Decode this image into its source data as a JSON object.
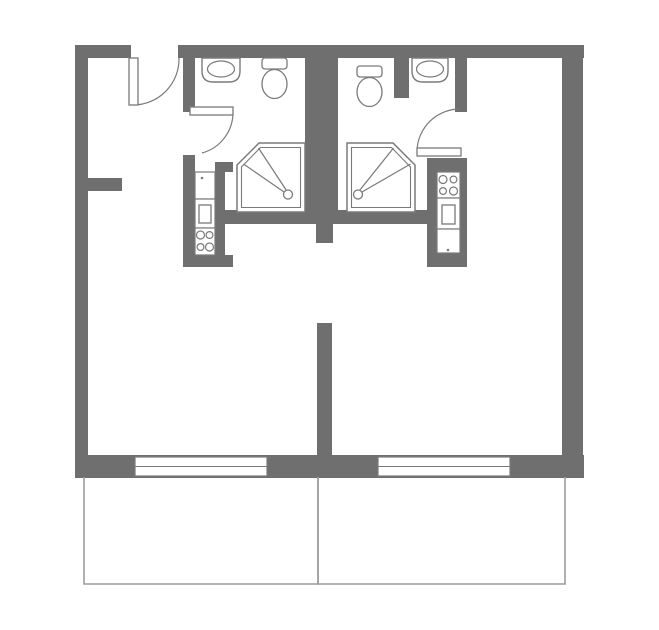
{
  "title": "two-studio-apartment-floor-plan",
  "canvas": {
    "width": 659,
    "height": 630,
    "background": "#ffffff"
  },
  "colors": {
    "wall": "#6f6f6f",
    "fixture_stroke": "#7a7a7a",
    "thin_line": "#9c9c9c",
    "fill": "#ffffff"
  },
  "walls": [
    {
      "name": "outer-wall-left",
      "rect": [
        75,
        45,
        13,
        433
      ]
    },
    {
      "name": "outer-wall-top-left-stub",
      "rect": [
        75,
        45,
        56,
        13
      ]
    },
    {
      "name": "outer-wall-top",
      "rect": [
        178,
        45,
        406,
        13
      ]
    },
    {
      "name": "outer-wall-right",
      "rect": [
        562,
        45,
        21,
        433
      ]
    },
    {
      "name": "outer-wall-bottom",
      "rect": [
        75,
        455,
        509,
        23
      ]
    },
    {
      "name": "hall-closet-stub",
      "rect": [
        88,
        178,
        34,
        13
      ]
    },
    {
      "name": "bath-left-wall-upper",
      "rect": [
        183,
        58,
        12,
        54
      ]
    },
    {
      "name": "bath-left-wall-lower",
      "rect": [
        183,
        155,
        12,
        112
      ]
    },
    {
      "name": "kitchen-left-wall-right",
      "rect": [
        215,
        162,
        10,
        95
      ]
    },
    {
      "name": "kitchen-left-wall-top",
      "rect": [
        215,
        162,
        18,
        10
      ]
    },
    {
      "name": "kitchen-left-wall-bottom",
      "rect": [
        183,
        255,
        50,
        12
      ]
    },
    {
      "name": "center-shaft-wall",
      "rect": [
        305,
        58,
        33,
        166
      ]
    },
    {
      "name": "shower-south-wall",
      "rect": [
        225,
        210,
        212,
        14
      ]
    },
    {
      "name": "room-divider-stub",
      "rect": [
        316,
        224,
        17,
        19
      ]
    },
    {
      "name": "room-divider-wall",
      "rect": [
        317,
        323,
        15,
        132
      ]
    },
    {
      "name": "bath-right-inner-stub",
      "rect": [
        394,
        58,
        15,
        40
      ]
    },
    {
      "name": "bath-right-wall-upper",
      "rect": [
        455,
        58,
        12,
        54
      ]
    },
    {
      "name": "kitchen-right-wall-top",
      "rect": [
        427,
        158,
        40,
        14
      ]
    },
    {
      "name": "kitchen-right-wall-left",
      "rect": [
        427,
        158,
        10,
        107
      ]
    },
    {
      "name": "kitchen-right-wall-back",
      "rect": [
        460,
        172,
        7,
        81
      ]
    },
    {
      "name": "kitchen-right-wall-bottom",
      "rect": [
        427,
        253,
        40,
        14
      ]
    }
  ],
  "doors": [
    {
      "name": "entry-door",
      "leaf": [
        129,
        58,
        9,
        47
      ],
      "arc": "M 133,105 A 46,46 0 0 0 179,58"
    },
    {
      "name": "bathroom-left-door",
      "leaf": [
        190,
        107,
        43,
        8
      ],
      "arc": "M 233,113 A 42,42 0 0 1 202,153"
    },
    {
      "name": "bathroom-right-door",
      "leaf": [
        417,
        148,
        44,
        8
      ],
      "arc": "M 417,151 A 43,43 0 0 1 460,109"
    }
  ],
  "windows": [
    {
      "name": "window-left",
      "rect": [
        135,
        457,
        132,
        19
      ],
      "midline_y": 466.5
    },
    {
      "name": "window-right",
      "rect": [
        378,
        457,
        132,
        19
      ],
      "midline_y": 466.5
    }
  ],
  "balconies": [
    {
      "name": "balcony-left",
      "path": "M 84,477 L 84,584 L 318,584 L 318,477"
    },
    {
      "name": "balcony-right",
      "path": "M 318,477 L 318,584 L 565,584 L 565,477"
    }
  ],
  "sinks": [
    {
      "name": "sink-left",
      "counter": "M 202,58 L 240,58 L 240,71 Q 240,82 229,82 L 213,82 Q 202,82 202,71 Z",
      "basin": {
        "cx": 221,
        "cy": 69,
        "rx": 13.5,
        "ry": 8
      }
    },
    {
      "name": "sink-right",
      "counter": "M 412,58 L 448,58 L 448,71 Q 448,82 437,82 L 423,82 Q 412,82 412,71 Z",
      "basin": {
        "cx": 430,
        "cy": 69,
        "rx": 13.5,
        "ry": 8
      }
    }
  ],
  "toilets": [
    {
      "name": "toilet-left",
      "tank": [
        262,
        58,
        25,
        11
      ],
      "bowl": {
        "cx": 274.5,
        "cy": 84,
        "rx": 12.5,
        "ry": 14.5
      }
    },
    {
      "name": "toilet-right",
      "tank": [
        357,
        66,
        25,
        11
      ],
      "bowl": {
        "cx": 369.5,
        "cy": 92,
        "rx": 12.5,
        "ry": 14.5
      }
    }
  ],
  "showers": [
    {
      "name": "shower-left",
      "outer": "259,143 305,143 305,212 237,212 237,165",
      "inner": "260.5,147.5 300.5,147.5 300.5,207.5 241.5,207.5 241.5,167",
      "head": {
        "cx": 288,
        "cy": 194.5,
        "r": 4.5
      },
      "spray": [
        [
          243.5,
          164,
          284,
          192
        ],
        [
          258.5,
          148,
          286.5,
          190.5
        ]
      ]
    },
    {
      "name": "shower-right",
      "outer": "347,143 393,143 415,165 415,212 347,212",
      "inner": "351.5,147.5 391.5,147.5 410.5,167 410.5,207.5 351.5,207.5",
      "head": {
        "cx": 358,
        "cy": 194.5,
        "r": 4.5
      },
      "spray": [
        [
          410.5,
          164,
          362,
          192
        ],
        [
          393.5,
          148,
          359.5,
          190.5
        ]
      ]
    }
  ],
  "kitchens": [
    {
      "name": "kitchenette-left",
      "units": [
        {
          "type": "counter",
          "rect": [
            195,
            172,
            20,
            27
          ]
        },
        {
          "type": "oven",
          "rect": [
            195,
            199,
            20,
            29
          ],
          "inner": [
            199,
            205,
            12,
            18
          ]
        },
        {
          "type": "stove",
          "rect": [
            195,
            228,
            20,
            27
          ],
          "burners": [
            [
              200.5,
              235,
              4
            ],
            [
              209.5,
              235,
              3.4
            ],
            [
              200.5,
              247,
              3.4
            ],
            [
              209.5,
              247,
              4
            ]
          ]
        }
      ],
      "dot": [
        202,
        178
      ]
    },
    {
      "name": "kitchenette-right",
      "units": [
        {
          "type": "stove",
          "rect": [
            437,
            172,
            23,
            26
          ],
          "burners": [
            [
              443,
              179.5,
              4
            ],
            [
              453.5,
              179.5,
              3.4
            ],
            [
              443,
              191,
              3.4
            ],
            [
              453.5,
              191,
              4
            ]
          ]
        },
        {
          "type": "oven",
          "rect": [
            437,
            198,
            23,
            31
          ],
          "inner": [
            442,
            205,
            13,
            19
          ]
        },
        {
          "type": "counter",
          "rect": [
            437,
            229,
            23,
            24
          ]
        }
      ],
      "dot": [
        448,
        250
      ]
    }
  ]
}
